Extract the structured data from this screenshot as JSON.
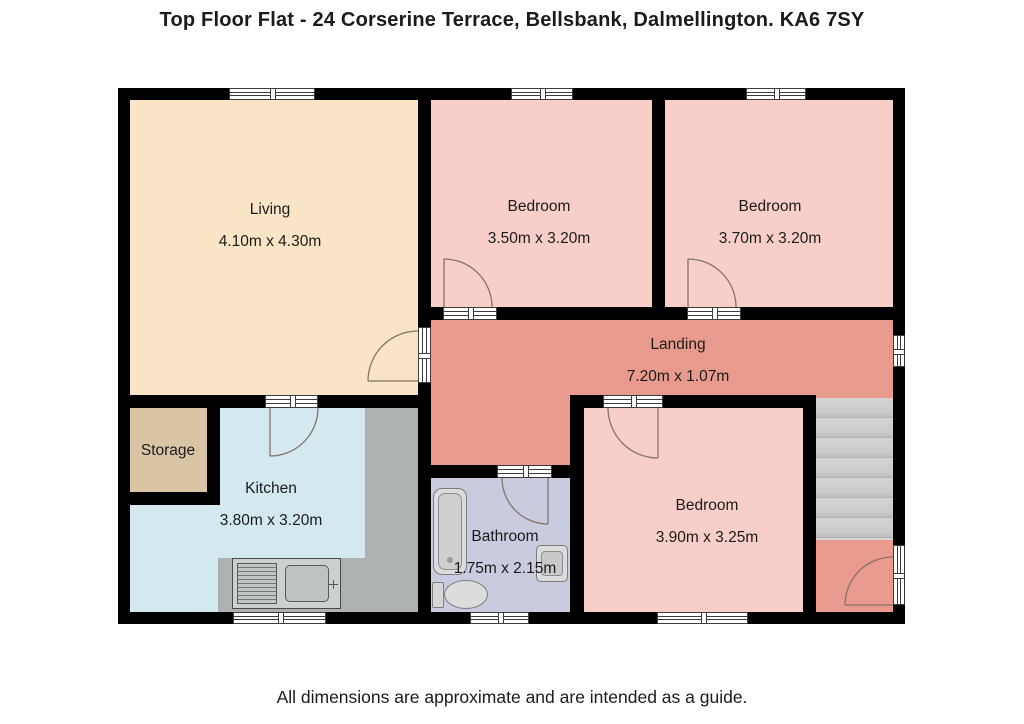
{
  "title": "Top Floor Flat - 24 Corserine Terrace, Bellsbank, Dalmellington. KA6 7SY",
  "footer": "All dimensions are approximate and are intended as a guide.",
  "rooms": {
    "living": {
      "name": "Living",
      "dims": "4.10m x 4.30m"
    },
    "bedroom_top_mid": {
      "name": "Bedroom",
      "dims": "3.50m x 3.20m"
    },
    "bedroom_top_right": {
      "name": "Bedroom",
      "dims": "3.70m x 3.20m"
    },
    "landing": {
      "name": "Landing",
      "dims": "7.20m x 1.07m"
    },
    "storage": {
      "name": "Storage"
    },
    "kitchen": {
      "name": "Kitchen",
      "dims": "3.80m x 3.20m"
    },
    "bathroom": {
      "name": "Bathroom",
      "dims": "1.75m x 2.15m"
    },
    "bedroom_bottom": {
      "name": "Bedroom",
      "dims": "3.90m x 3.25m"
    }
  },
  "colors": {
    "living": "#f9e4c6",
    "bedroom": "#f8cfc8",
    "landing": "#e89b8c",
    "storage": "#d9c5a4",
    "kitchen": "#d4e9ef",
    "bathroom": "#c9cbde",
    "counter": "#aeb1b1",
    "wall": "#000000",
    "text": "#1b1b1b"
  }
}
